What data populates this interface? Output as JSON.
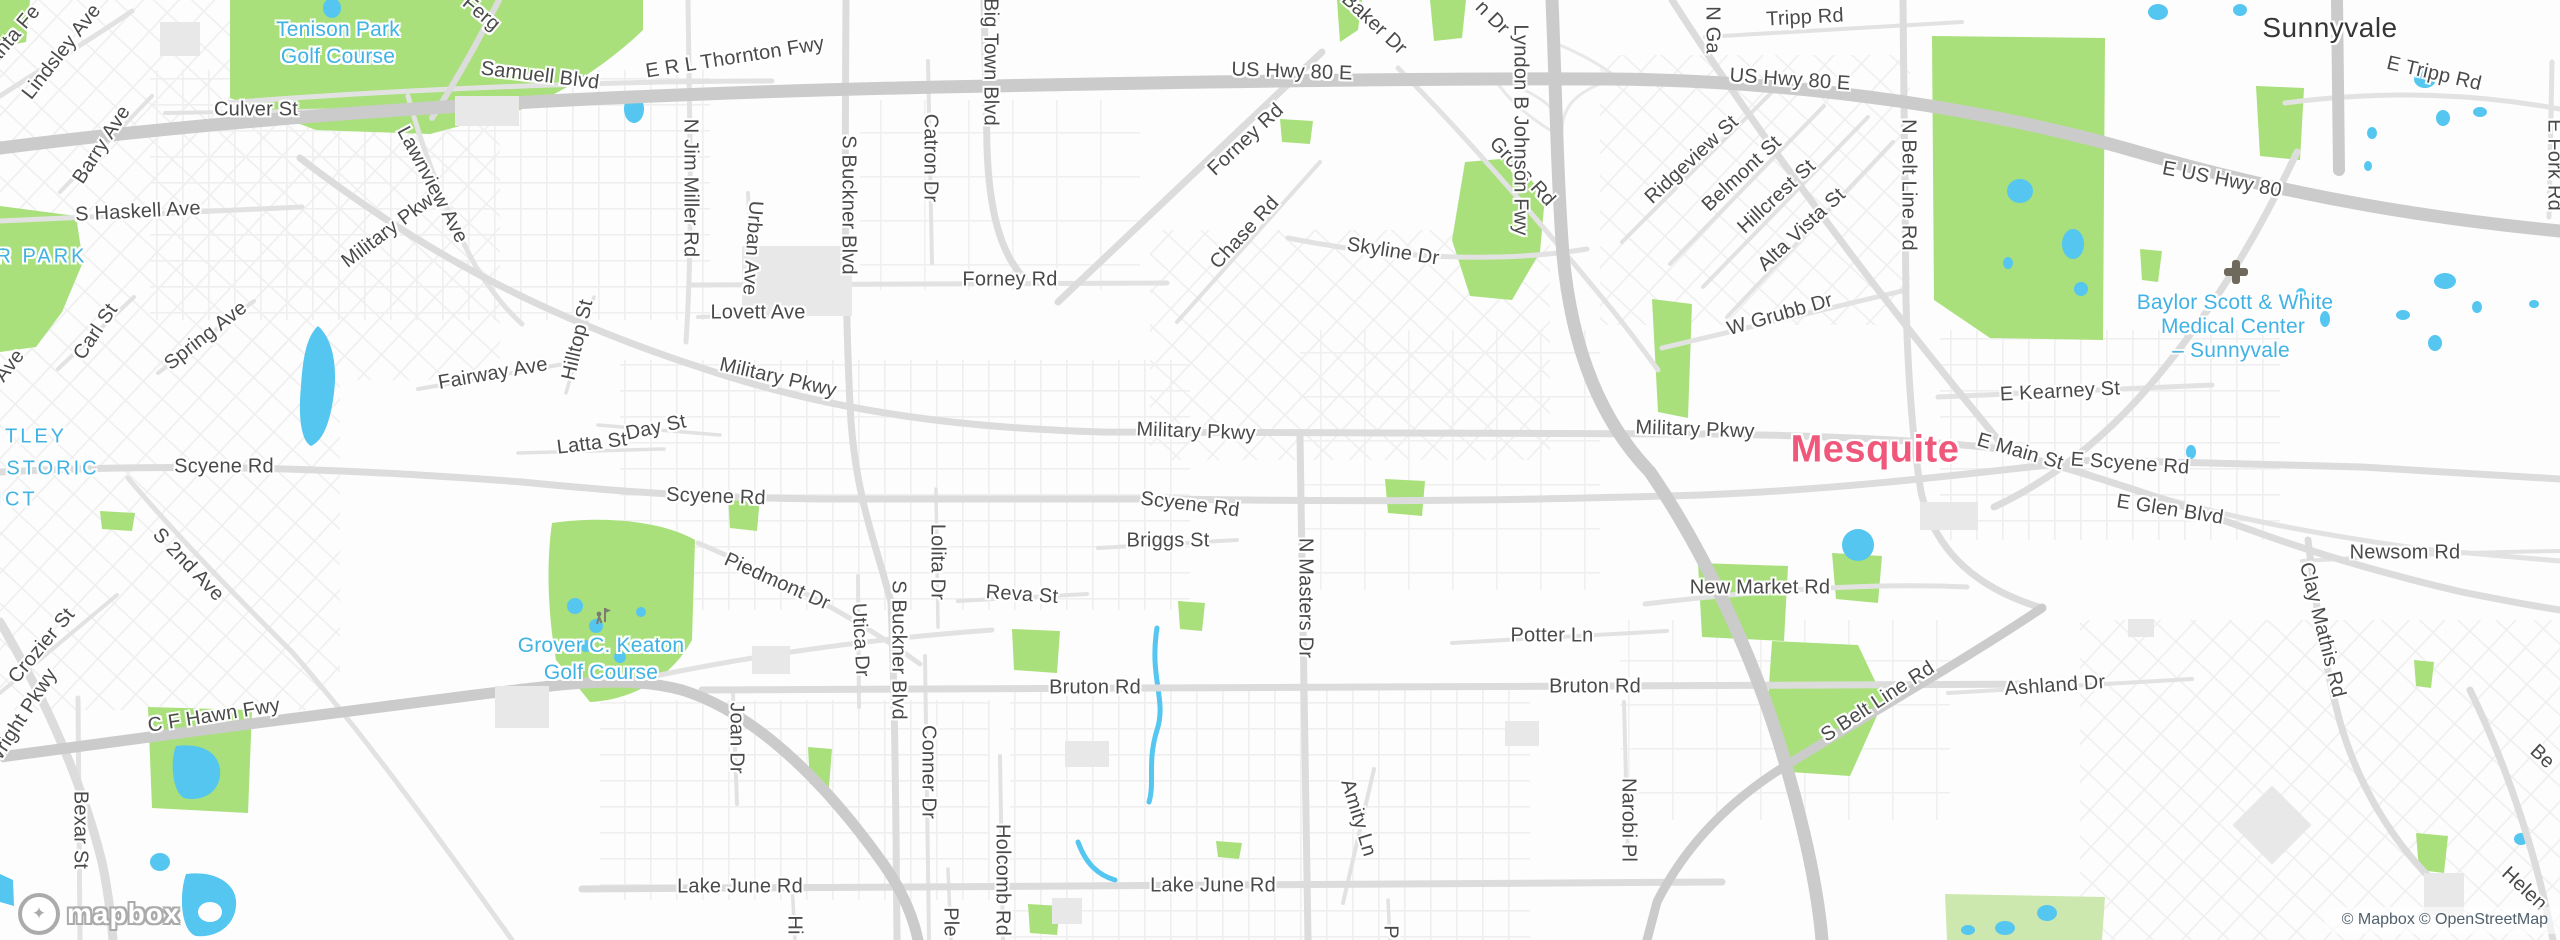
{
  "attribution": {
    "mapbox": "© Mapbox",
    "osm": "© OpenStreetMap"
  },
  "logo": {
    "text": "mapbox"
  },
  "colors": {
    "water": "#54c6f0",
    "park": "#a9e07b",
    "road": "#dcdcdc",
    "freeway": "#cbcbcb",
    "street_label": "#4a4a4a",
    "poi_label": "#41b2e4",
    "city_minor": "#363636",
    "city_major": "#f0587b"
  },
  "labels": [
    {
      "t": "Santa Fe",
      "x": 10,
      "y": 40,
      "r": -50
    },
    {
      "t": "Lindsley Ave",
      "x": 62,
      "y": 52,
      "r": -52
    },
    {
      "t": "Ferg",
      "x": 481,
      "y": 14,
      "r": 40
    },
    {
      "t": "Tenison Park",
      "x": 338,
      "y": 30,
      "k": "poi"
    },
    {
      "t": "Golf Course",
      "x": 338,
      "y": 57,
      "k": "poi"
    },
    {
      "t": "Samuell Blvd",
      "x": 540,
      "y": 76,
      "r": 7
    },
    {
      "t": "E R L Thornton Fwy",
      "x": 735,
      "y": 58,
      "r": -9
    },
    {
      "t": "Culver St",
      "x": 256,
      "y": 110,
      "r": 0
    },
    {
      "t": "Barry Ave",
      "x": 102,
      "y": 145,
      "r": -57
    },
    {
      "t": "S Haskell Ave",
      "x": 138,
      "y": 212,
      "r": -3
    },
    {
      "t": "Military Pkwy",
      "x": 392,
      "y": 228,
      "r": -37
    },
    {
      "t": "Lawnview Ave",
      "x": 432,
      "y": 185,
      "r": 62
    },
    {
      "t": "N Jim Miller Rd",
      "x": 690,
      "y": 188,
      "r": 90
    },
    {
      "t": "Urban Ave",
      "x": 752,
      "y": 248,
      "r": 94
    },
    {
      "t": "S Buckner Blvd",
      "x": 848,
      "y": 205,
      "r": 90
    },
    {
      "t": "Catron Dr",
      "x": 930,
      "y": 158,
      "r": 90
    },
    {
      "t": "Big Town Blvd",
      "x": 990,
      "y": 62,
      "r": 90
    },
    {
      "t": "US Hwy 80 E",
      "x": 1292,
      "y": 72,
      "r": 2
    },
    {
      "t": "Baker Dr",
      "x": 1374,
      "y": 24,
      "r": 43
    },
    {
      "t": "n Dr",
      "x": 1492,
      "y": 18,
      "r": 45
    },
    {
      "t": "Forney Rd",
      "x": 1246,
      "y": 140,
      "r": -43
    },
    {
      "t": "Chase Rd",
      "x": 1245,
      "y": 233,
      "r": -47
    },
    {
      "t": "Skyline Dr",
      "x": 1393,
      "y": 252,
      "r": 9
    },
    {
      "t": "Gross Rd",
      "x": 1522,
      "y": 172,
      "r": 47
    },
    {
      "t": "Lyndon B Johnson Fwy",
      "x": 1520,
      "y": 130,
      "r": 90
    },
    {
      "t": "N Ga",
      "x": 1712,
      "y": 30,
      "r": 90
    },
    {
      "t": "Tripp Rd",
      "x": 1805,
      "y": 18,
      "r": -3
    },
    {
      "t": "US Hwy 80 E",
      "x": 1790,
      "y": 80,
      "r": 4
    },
    {
      "t": "Ridgeview St",
      "x": 1692,
      "y": 160,
      "r": -43
    },
    {
      "t": "Belmont St",
      "x": 1742,
      "y": 174,
      "r": -43
    },
    {
      "t": "Hillcrest St",
      "x": 1777,
      "y": 197,
      "r": -43
    },
    {
      "t": "Alta Vista St",
      "x": 1802,
      "y": 230,
      "r": -43
    },
    {
      "t": "N Belt Line Rd",
      "x": 1908,
      "y": 185,
      "r": 90
    },
    {
      "t": "Sunnyvale",
      "x": 2330,
      "y": 28,
      "k": "city"
    },
    {
      "t": "E Tripp Rd",
      "x": 2434,
      "y": 74,
      "r": 13
    },
    {
      "t": "E US Hwy 80",
      "x": 2222,
      "y": 180,
      "r": 11
    },
    {
      "t": "E Fork Rd",
      "x": 2554,
      "y": 165,
      "r": 90
    },
    {
      "t": "Baylor Scott & White",
      "x": 2235,
      "y": 303,
      "k": "poi"
    },
    {
      "t": "Medical Center",
      "x": 2233,
      "y": 327,
      "k": "poi"
    },
    {
      "t": "– Sunnyvale",
      "x": 2231,
      "y": 351,
      "k": "poi"
    },
    {
      "t": "W Grubb Dr",
      "x": 1780,
      "y": 315,
      "r": -16
    },
    {
      "t": "E Kearney St",
      "x": 2060,
      "y": 392,
      "r": -3
    },
    {
      "t": "Mesquite",
      "x": 1875,
      "y": 450,
      "k": "city2"
    },
    {
      "t": "Military Pkwy",
      "x": 1695,
      "y": 430,
      "r": 2
    },
    {
      "t": "E Main St",
      "x": 2020,
      "y": 452,
      "r": 16
    },
    {
      "t": "E Scyene Rd",
      "x": 2130,
      "y": 464,
      "r": 4
    },
    {
      "t": "E Glen Blvd",
      "x": 2170,
      "y": 510,
      "r": 9
    },
    {
      "t": "Newsom Rd",
      "x": 2405,
      "y": 553,
      "r": 0
    },
    {
      "t": "Clay Mathis Rd",
      "x": 2322,
      "y": 630,
      "r": 76
    },
    {
      "t": "R PARK",
      "x": 42,
      "y": 257,
      "k": "area"
    },
    {
      "t": "Ave",
      "x": 10,
      "y": 366,
      "r": -52
    },
    {
      "t": "TLEY",
      "x": 36,
      "y": 437,
      "k": "area"
    },
    {
      "t": "STORIC",
      "x": 53,
      "y": 469,
      "k": "area"
    },
    {
      "t": "ICT",
      "x": 17,
      "y": 500,
      "k": "area"
    },
    {
      "t": "Spring Ave",
      "x": 206,
      "y": 336,
      "r": -38
    },
    {
      "t": "Carl St",
      "x": 96,
      "y": 332,
      "r": -56
    },
    {
      "t": "Scyene Rd",
      "x": 224,
      "y": 467,
      "r": 0
    },
    {
      "t": "S 2nd Ave",
      "x": 188,
      "y": 565,
      "r": 46
    },
    {
      "t": "Crozier St",
      "x": 42,
      "y": 646,
      "r": -50
    },
    {
      "t": "Wright Pkwy",
      "x": 22,
      "y": 718,
      "r": -57
    },
    {
      "t": "Bexar St",
      "x": 80,
      "y": 830,
      "r": 90
    },
    {
      "t": "C F Hawn Fwy",
      "x": 214,
      "y": 716,
      "r": -9
    },
    {
      "t": "Fairway Ave",
      "x": 493,
      "y": 374,
      "r": -10
    },
    {
      "t": "Hilltop St",
      "x": 578,
      "y": 340,
      "r": -77
    },
    {
      "t": "Day St",
      "x": 656,
      "y": 428,
      "r": -12
    },
    {
      "t": "Latta St",
      "x": 592,
      "y": 444,
      "r": -7
    },
    {
      "t": "Lovett Ave",
      "x": 758,
      "y": 313,
      "r": 0
    },
    {
      "t": "Military Pkwy",
      "x": 778,
      "y": 378,
      "r": 13
    },
    {
      "t": "Forney Rd",
      "x": 1010,
      "y": 280,
      "r": 0
    },
    {
      "t": "Military Pkwy",
      "x": 1196,
      "y": 432,
      "r": 2
    },
    {
      "t": "Scyene Rd",
      "x": 716,
      "y": 497,
      "r": 2
    },
    {
      "t": "Scyene Rd",
      "x": 1190,
      "y": 505,
      "r": 7
    },
    {
      "t": "Piedmont Dr",
      "x": 777,
      "y": 582,
      "r": 24
    },
    {
      "t": "Briggs St",
      "x": 1168,
      "y": 541,
      "r": 0
    },
    {
      "t": "Reva St",
      "x": 1022,
      "y": 595,
      "r": 4
    },
    {
      "t": "Lolita Dr",
      "x": 937,
      "y": 562,
      "r": 90
    },
    {
      "t": "Utica Dr",
      "x": 860,
      "y": 640,
      "r": 87
    },
    {
      "t": "S Buckner Blvd",
      "x": 898,
      "y": 650,
      "r": 90
    },
    {
      "t": "N Masters Dr",
      "x": 1305,
      "y": 598,
      "r": 90
    },
    {
      "t": "Grover C. Keaton",
      "x": 601,
      "y": 646,
      "k": "poi"
    },
    {
      "t": "Golf Course",
      "x": 601,
      "y": 673,
      "k": "poi"
    },
    {
      "t": "New Market Rd",
      "x": 1760,
      "y": 588,
      "r": 0
    },
    {
      "t": "Potter Ln",
      "x": 1552,
      "y": 636,
      "r": 0
    },
    {
      "t": "Bruton Rd",
      "x": 1095,
      "y": 688,
      "r": 0
    },
    {
      "t": "Bruton Rd",
      "x": 1595,
      "y": 687,
      "r": 0
    },
    {
      "t": "Joan Dr",
      "x": 736,
      "y": 738,
      "r": 90
    },
    {
      "t": "Conner Dr",
      "x": 928,
      "y": 772,
      "r": 90
    },
    {
      "t": "Holcomb Rd",
      "x": 1002,
      "y": 880,
      "r": 90
    },
    {
      "t": "Ple",
      "x": 950,
      "y": 922,
      "r": 90
    },
    {
      "t": "Hi",
      "x": 794,
      "y": 925,
      "r": 90
    },
    {
      "t": "P",
      "x": 1390,
      "y": 932,
      "r": 90
    },
    {
      "t": "Lake June Rd",
      "x": 740,
      "y": 887,
      "r": 0
    },
    {
      "t": "Lake June Rd",
      "x": 1213,
      "y": 886,
      "r": 0
    },
    {
      "t": "Amity Ln",
      "x": 1358,
      "y": 818,
      "r": 73
    },
    {
      "t": "Narobi Pl",
      "x": 1628,
      "y": 820,
      "r": 90
    },
    {
      "t": "S Belt Line Rd",
      "x": 1878,
      "y": 702,
      "r": -33
    },
    {
      "t": "Ashland Dr",
      "x": 2055,
      "y": 686,
      "r": -4
    },
    {
      "t": "Be",
      "x": 2542,
      "y": 757,
      "r": 43
    },
    {
      "t": "Helen",
      "x": 2524,
      "y": 889,
      "r": 43
    }
  ]
}
